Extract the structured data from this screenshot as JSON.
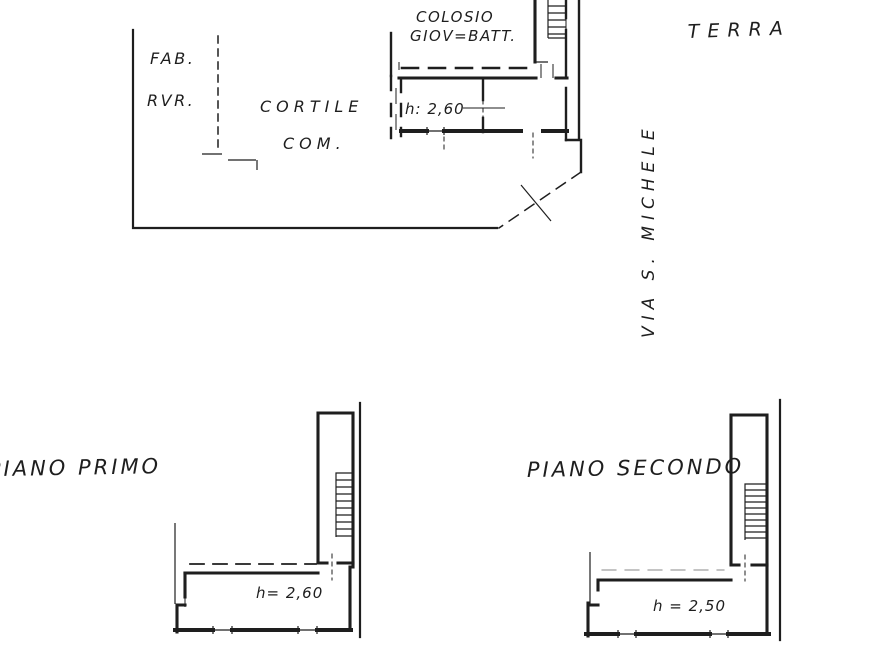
{
  "document": {
    "kind": "hand-drawn cadastral floor plan, scanned"
  },
  "colors": {
    "ink": "#1e1e1e",
    "paper": "#ffffff",
    "faint_ink": "#8a8a8a"
  },
  "ground_floor": {
    "neighbor_line1": "COLOSIO",
    "neighbor_line2": "GIOV=BATT.",
    "floor_label": "TERRA",
    "adjacent_building_line1": "FAB.",
    "adjacent_building_line2": "RVR.",
    "courtyard_line1": "CORTILE",
    "courtyard_line2": "COM.",
    "room_height": "h: 2,60",
    "street_name": "VIA S. MICHELE"
  },
  "first_floor": {
    "title": "PIANO PRIMO",
    "room_height": "h= 2,60"
  },
  "second_floor": {
    "title": "PIANO SECONDO",
    "room_height": "h = 2,50"
  }
}
